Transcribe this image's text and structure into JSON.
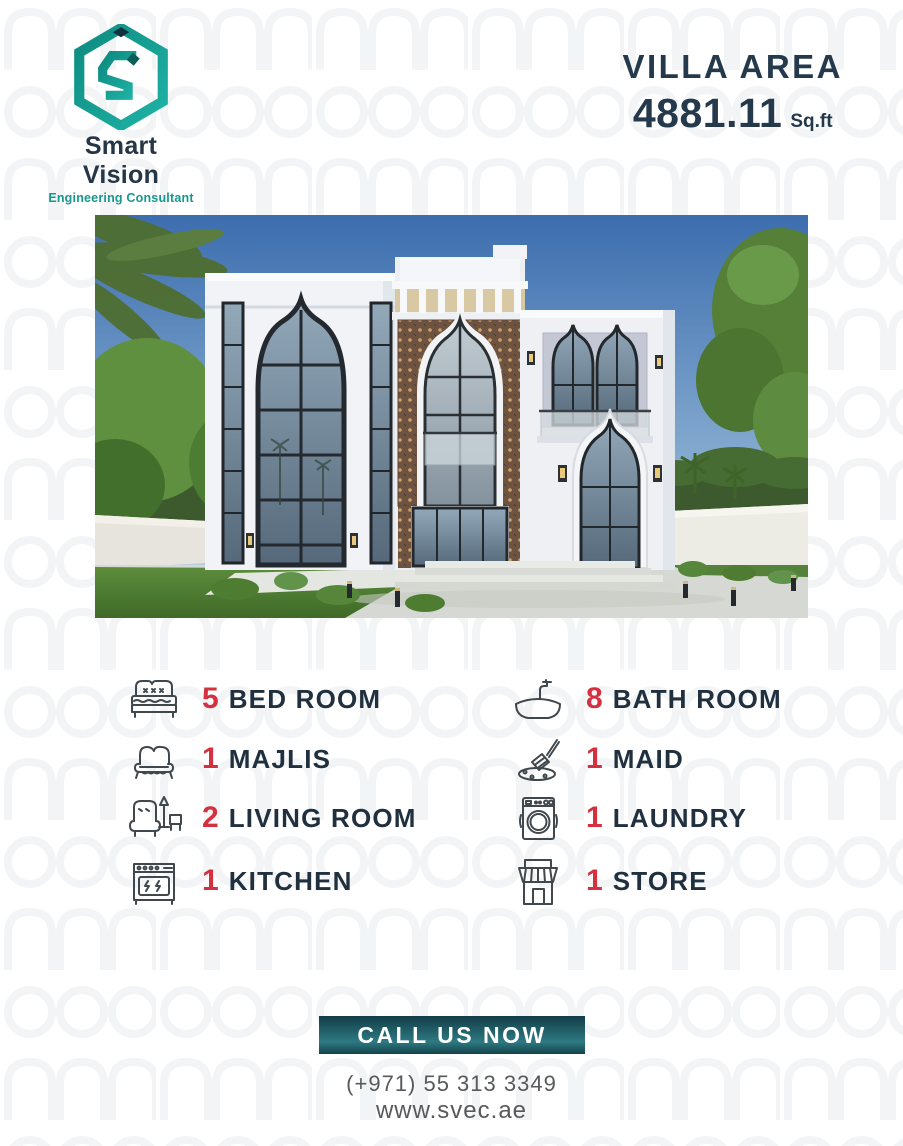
{
  "brand": {
    "name": "Smart Vision",
    "tagline": "Engineering Consultant"
  },
  "villa_area": {
    "label": "VILLA AREA",
    "value": "4881.11",
    "unit": "Sq.ft"
  },
  "features": {
    "left": [
      {
        "count": "5",
        "label": "BED ROOM",
        "icon": "bed-icon"
      },
      {
        "count": "1",
        "label": "MAJLIS",
        "icon": "sofa-icon"
      },
      {
        "count": "2",
        "label": "LIVING ROOM",
        "icon": "armchair-lamp-icon"
      },
      {
        "count": "1",
        "label": "KITCHEN",
        "icon": "stove-icon"
      }
    ],
    "right": [
      {
        "count": "8",
        "label": "BATH ROOM",
        "icon": "bathtub-icon"
      },
      {
        "count": "1",
        "label": "MAID",
        "icon": "cleaning-brush-icon"
      },
      {
        "count": "1",
        "label": "LAUNDRY",
        "icon": "washing-machine-icon"
      },
      {
        "count": "1",
        "label": "STORE",
        "icon": "storefront-icon"
      }
    ]
  },
  "cta": {
    "button_label": "CALL US NOW",
    "phone": "(+971) 55 313 3349",
    "website": "www.svec.ae"
  },
  "colors": {
    "navy": "#22313F",
    "accent_red": "#D5303F",
    "teal": "#17988C",
    "button_gradient_top": "#123C46",
    "button_gradient_bottom": "#2E7A82",
    "muted_text": "#58595B"
  }
}
